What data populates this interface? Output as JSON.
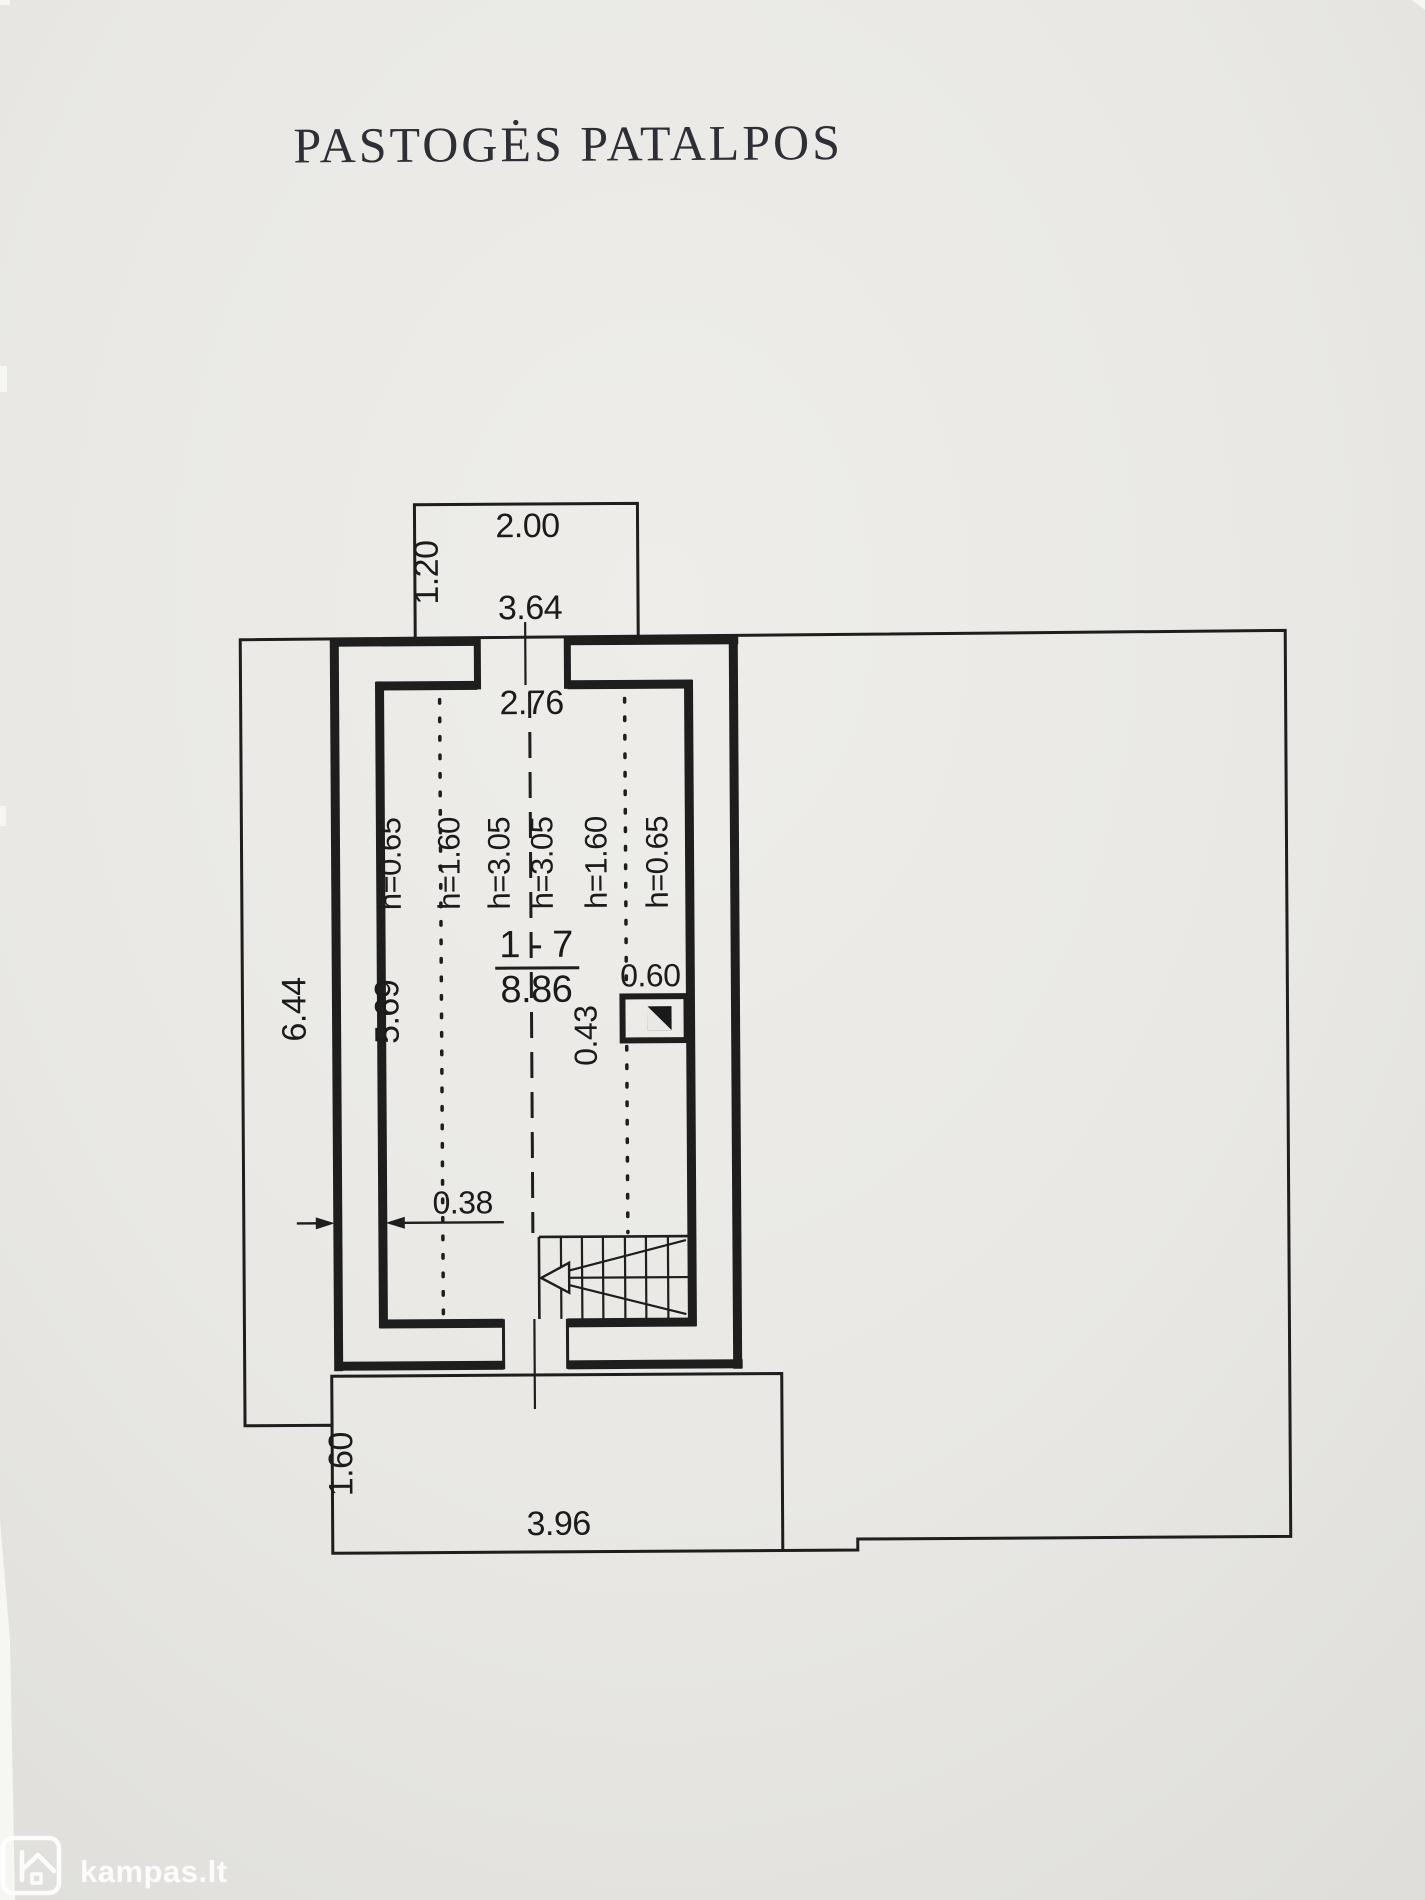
{
  "document": {
    "title": "PASTOGĖS PATALPOS"
  },
  "plan": {
    "dormer": {
      "width": "2.00",
      "depth": "1.20"
    },
    "room": {
      "outer_width": "3.64",
      "outer_length": "6.44",
      "inner_width": "2.76",
      "inner_length": "5.69",
      "wall_thickness": "0.38",
      "number": "1 - 7",
      "area": "8.86",
      "height_marks": [
        "h=0.65",
        "h=1.60",
        "h=3.05",
        "h=3.05",
        "h=1.60",
        "h=0.65"
      ]
    },
    "chimney": {
      "width": "0.60",
      "depth": "0.43"
    },
    "porch": {
      "depth": "1.60",
      "width": "3.96"
    }
  },
  "watermark": {
    "brand": "kampas.lt"
  },
  "colors": {
    "paper": "#e9e8e4",
    "ink": "#1c1c1c",
    "watermark": "#ffffff"
  }
}
